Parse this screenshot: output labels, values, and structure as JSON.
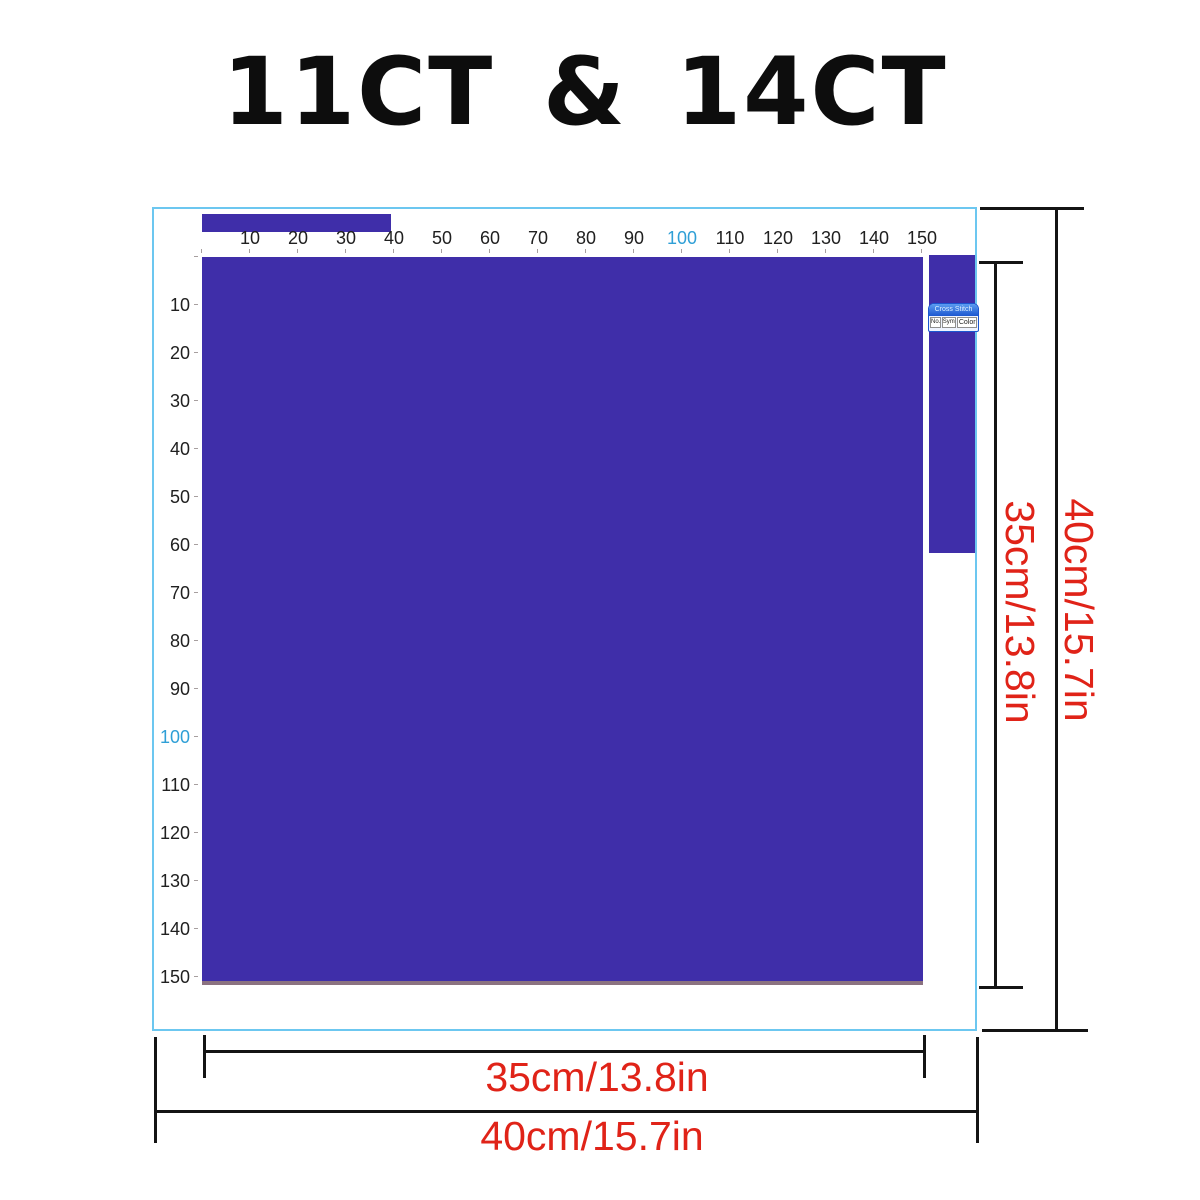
{
  "title": "11CT & 14CT",
  "colors": {
    "design_purple": "#3f2ea9",
    "outline_blue": "#6cc7f0",
    "dimension_red": "#e02318",
    "ruler_highlight": "#2f9fd6",
    "ruler_number": "#202020",
    "line_black": "#141414",
    "square_bottom_edge": "#8b7280",
    "miniwin_blue": "#1c57d0"
  },
  "rulers": {
    "top": {
      "values": [
        "10",
        "20",
        "30",
        "40",
        "50",
        "60",
        "70",
        "80",
        "90",
        "100",
        "110",
        "120",
        "130",
        "140",
        "150"
      ],
      "highlighted_value": "100"
    },
    "left": {
      "values": [
        "10",
        "20",
        "30",
        "40",
        "50",
        "60",
        "70",
        "80",
        "90",
        "100",
        "110",
        "120",
        "130",
        "140",
        "150"
      ],
      "highlighted_value": "100"
    }
  },
  "mini_window": {
    "title": "Cross Stitch",
    "buttons": [
      "No.",
      "Symbol",
      "Color"
    ]
  },
  "dimension_labels": {
    "inner_width": "35cm/13.8in",
    "outer_width": "40cm/15.7in",
    "inner_height": "35cm/13.8in",
    "outer_height": "40cm/15.7in"
  }
}
